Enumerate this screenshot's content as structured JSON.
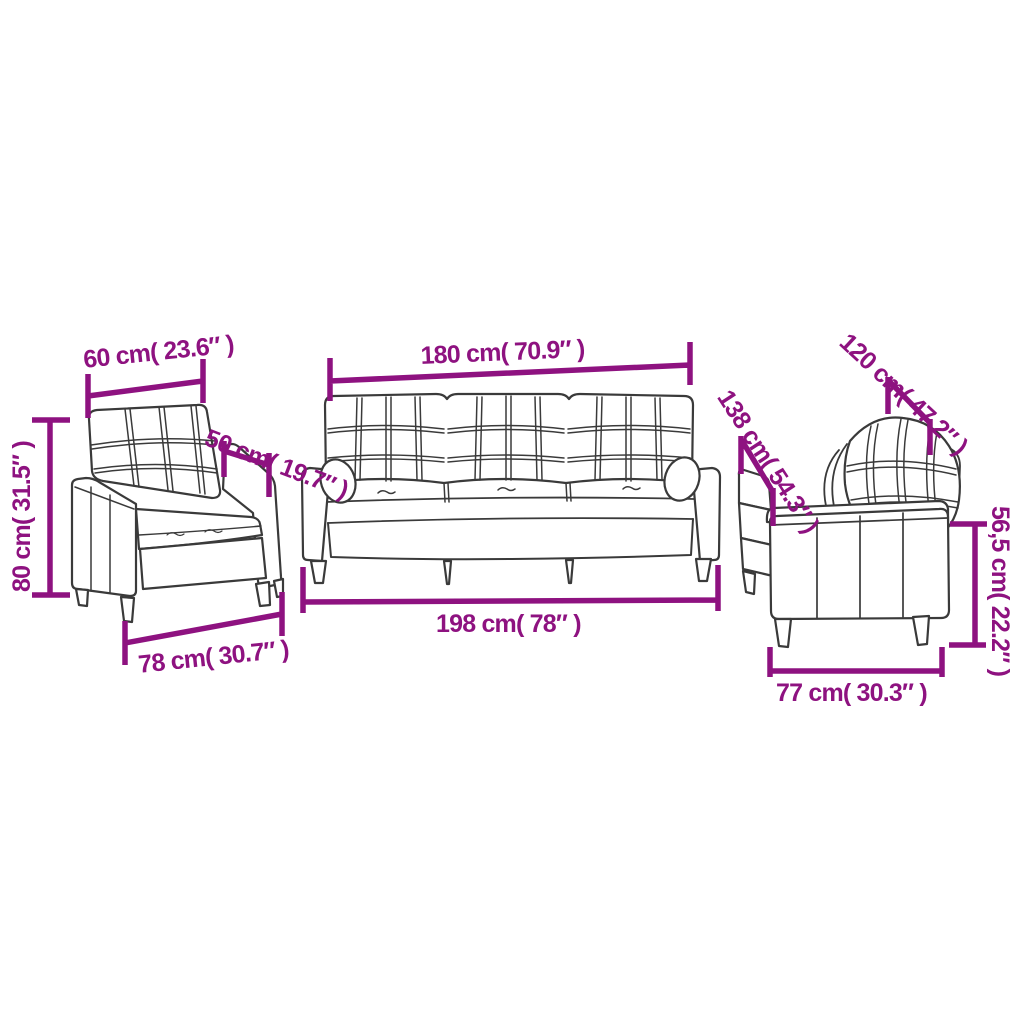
{
  "diagram": {
    "description": "3 piece sofa set dimension diagram: armchair, 3-seater sofa, 2-seater sofa",
    "accent_color": "#8E1280",
    "sketch_color": "#3A3A3A",
    "background_color": "#FFFFFF"
  },
  "labels": {
    "armchair_back_width": "60 cm( 23.6″ )",
    "armchair_height": "80 cm( 31.5″ )",
    "armchair_seat_depth": "50 cm( 19.7″ )",
    "armchair_depth": "78 cm( 30.7″ )",
    "sofa_back_width": "180 cm( 70.9″ )",
    "sofa_total_width": "198 cm( 78″ )",
    "loveseat_back_width": "120 cm( 47.2″ )",
    "loveseat_total_width": "138 cm( 54.3″ )",
    "loveseat_arm_height": "56,5 cm( 22.2″ )",
    "loveseat_depth": "77 cm( 30.3″ )"
  }
}
